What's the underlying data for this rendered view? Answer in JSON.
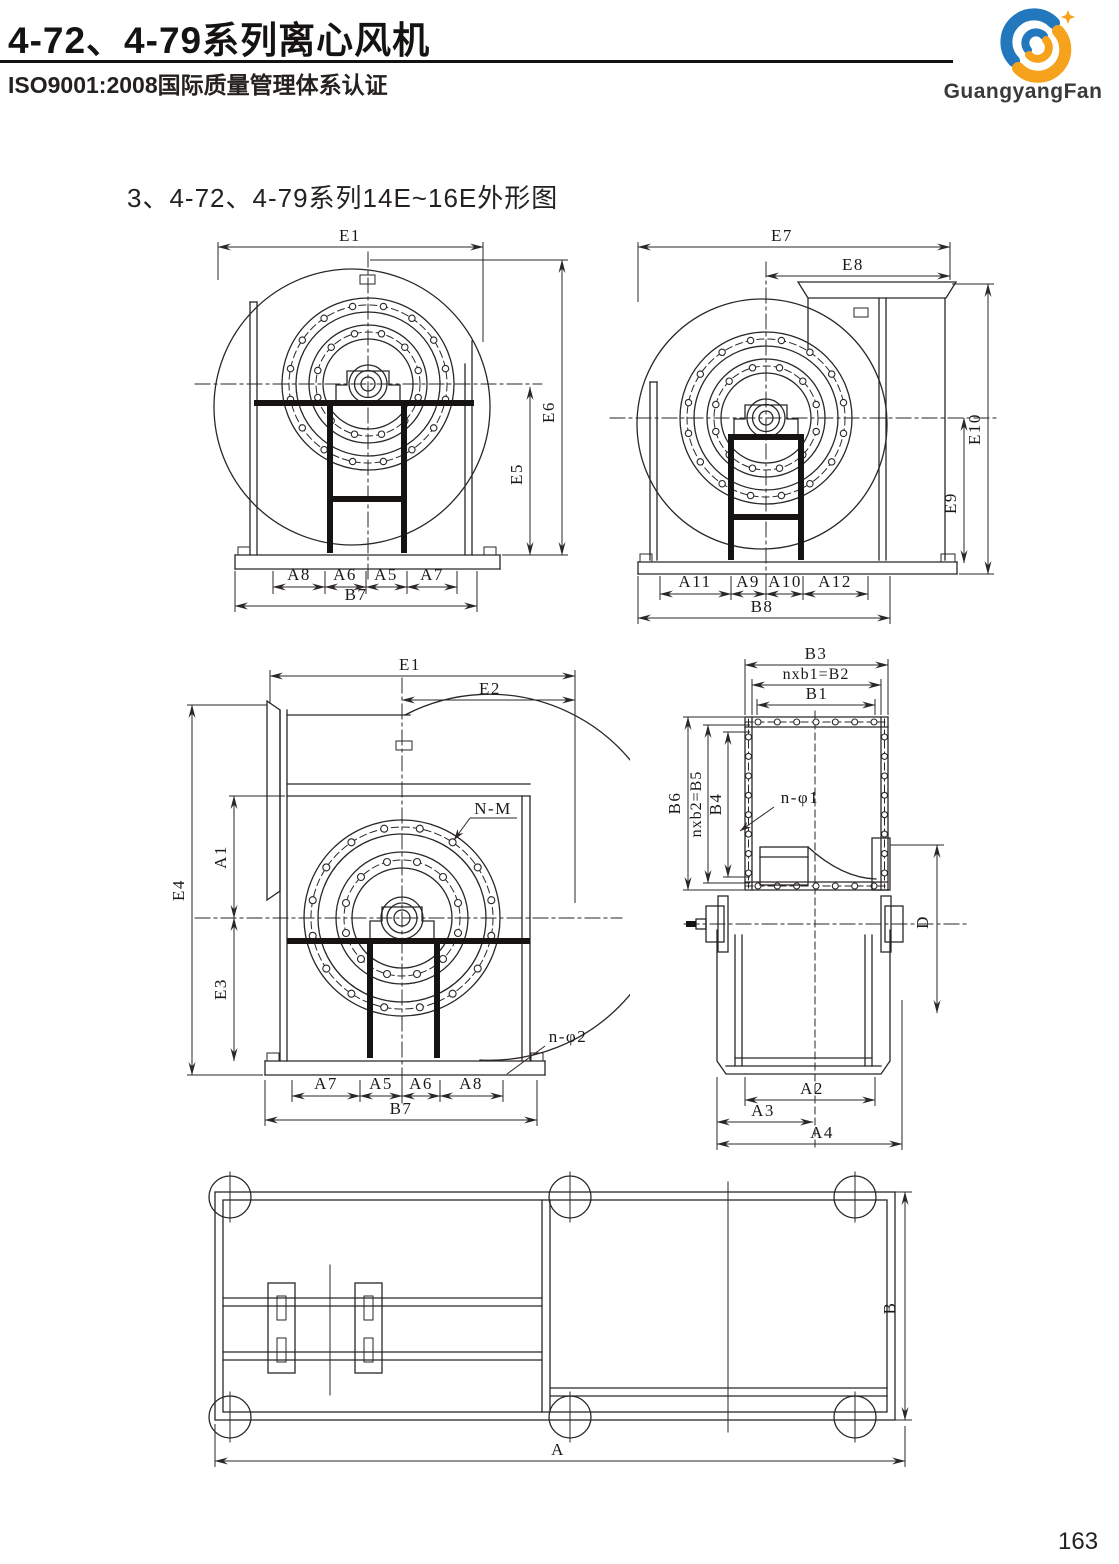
{
  "header": {
    "title": "4-72、4-79系列离心风机",
    "subtitle": "ISO9001:2008国际质量管理体系认证",
    "brand": "GuangyangFan"
  },
  "section_title": "3、4-72、4-79系列14E~16E外形图",
  "page_number": "163",
  "colors": {
    "line": "#2b2726",
    "text": "#1c1a19",
    "logo_blue": "#2277bd",
    "logo_orange": "#f6a21c"
  },
  "d1": {
    "e1": "E1",
    "e6": "E6",
    "e5": "E5",
    "a8": "A8",
    "a6": "A6",
    "a5": "A5",
    "a7": "A7",
    "b7": "B7"
  },
  "d2": {
    "e7": "E7",
    "e8": "E8",
    "e10": "E10",
    "e9": "E9",
    "a11": "A11",
    "a9": "A9",
    "a10": "A10",
    "a12": "A12",
    "b8": "B8"
  },
  "d3": {
    "e1": "E1",
    "e2": "E2",
    "e4": "E4",
    "a1": "A1",
    "e3": "E3",
    "n_m": "N-M",
    "n_phi2": "n-φ2",
    "a7": "A7",
    "a5": "A5",
    "a6": "A6",
    "a8": "A8",
    "b7": "B7"
  },
  "d4": {
    "b3": "B3",
    "b2": "nxb1=B2",
    "b1": "B1",
    "b6": "B6",
    "b5": "nxb2=B5",
    "b4": "B4",
    "n_phi1": "n-φ1",
    "d": "D",
    "a2": "A2",
    "a3": "A3",
    "a4": "A4"
  },
  "d5": {
    "b": "B",
    "a": "A"
  }
}
